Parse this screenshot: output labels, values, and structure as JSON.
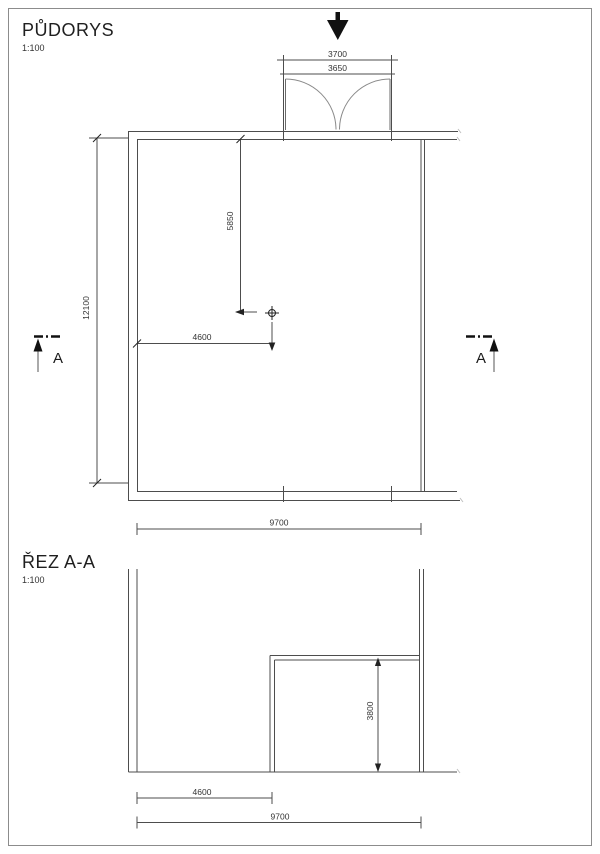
{
  "plan": {
    "title": "PŮDORYS",
    "scale": "1:100",
    "dim_opening_outer": "3700",
    "dim_opening_inner": "3650",
    "dim_total_height": "12100",
    "dim_interior_vertical": "5850",
    "dim_interior_horizontal": "4600",
    "dim_total_width": "9700",
    "section_marker_left": "A",
    "section_marker_right": "A"
  },
  "section": {
    "title": "ŘEZ A-A",
    "scale": "1:100",
    "dim_box_height": "3800",
    "dim_left_width": "4600",
    "dim_total_width": "9700"
  },
  "colors": {
    "line": "#4d4d4d",
    "heavy": "#111111",
    "sheet_border": "#8c8c8c",
    "background": "#ffffff"
  }
}
